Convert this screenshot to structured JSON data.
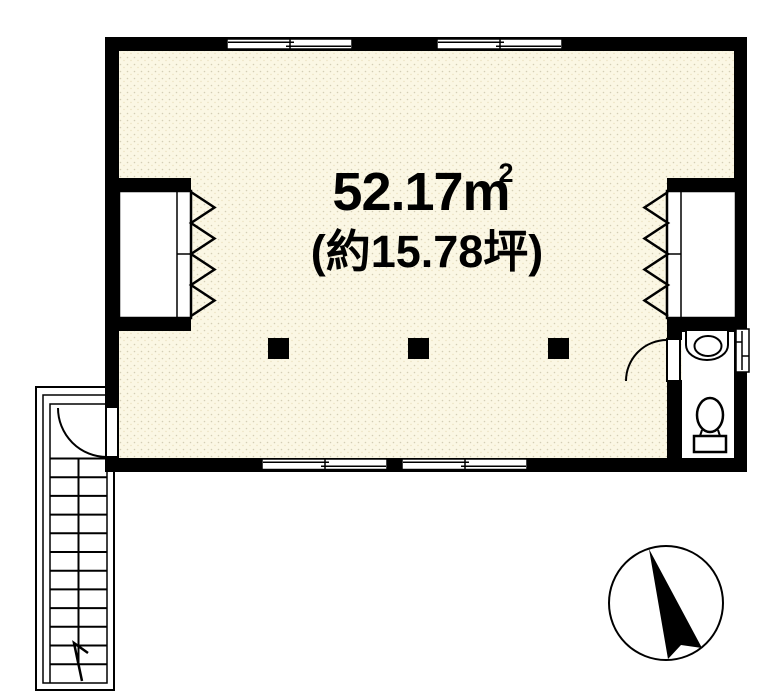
{
  "floorplan": {
    "area_label": "52.17m",
    "area_superscript": "2",
    "area_tsubo_label": "(約15.78坪)",
    "colors": {
      "wall": "#000000",
      "floor": "#FBF7E4",
      "fixture": "#FFFFFF"
    },
    "fixtures": {
      "closet_count": 2,
      "pillar_count": 3,
      "window_count": 5,
      "compass": "north-arrow"
    },
    "stairs": {
      "tread_count": 12
    }
  }
}
